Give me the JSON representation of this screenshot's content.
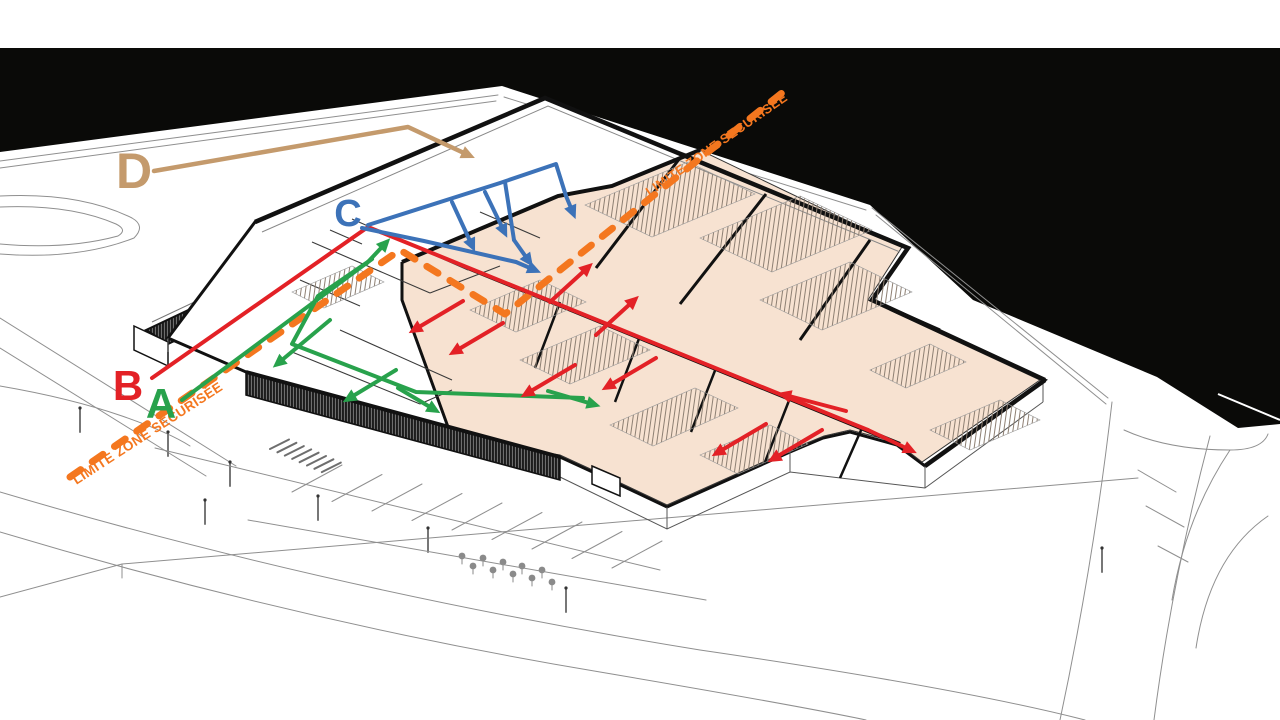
{
  "diagram": {
    "kind": "axonometric-building-security-circulation-diagram",
    "language": "fr"
  },
  "colors": {
    "page": "#ffffff",
    "water": "#0a0a08",
    "room_fill": "#f7e2d1",
    "building_line": "#141414",
    "site_line": "#8f8f8f",
    "boundary_orange": "#f4771f",
    "route_a_green": "#28a24c",
    "route_b_red": "#e32126",
    "route_c_blue": "#3c72b8",
    "route_d_tan": "#c49a6c"
  },
  "boundary": {
    "label": "LIMITE ZONE SECURISÉE",
    "color_key": "boundary_orange",
    "dash_polyline": [
      [
        70,
        477
      ],
      [
        400,
        250
      ],
      [
        505,
        314
      ],
      [
        792,
        85
      ]
    ],
    "texts": [
      {
        "x": 150,
        "y": 437,
        "rotation": -33,
        "size": 13.5
      },
      {
        "x": 719,
        "y": 148,
        "rotation": -35,
        "size": 13
      }
    ]
  },
  "routes": [
    {
      "id": "a",
      "label": "A",
      "color_key": "route_a_green",
      "width": 4,
      "label_x": 161,
      "label_y": 418,
      "label_size": 42,
      "paths": [
        [
          [
            182,
            400
          ],
          [
            372,
            259
          ]
        ],
        [
          [
            372,
            259
          ],
          [
            318,
            296
          ],
          [
            292,
            344
          ],
          [
            416,
            392
          ],
          [
            583,
            398
          ]
        ]
      ],
      "arrows": [
        [
          [
            366,
            264
          ],
          [
            382,
            247
          ]
        ],
        [
          [
            330,
            320
          ],
          [
            282,
            360
          ]
        ],
        [
          [
            396,
            370
          ],
          [
            353,
            396
          ]
        ],
        [
          [
            398,
            388
          ],
          [
            430,
            407
          ]
        ],
        [
          [
            548,
            391
          ],
          [
            589,
            403
          ]
        ]
      ]
    },
    {
      "id": "b",
      "label": "B",
      "color_key": "route_b_red",
      "width": 4,
      "label_x": 128,
      "label_y": 400,
      "label_size": 42,
      "paths": [
        [
          [
            152,
            378
          ],
          [
            368,
            227
          ],
          [
            868,
            430
          ]
        ]
      ],
      "arrows": [
        [
          [
            463,
            301
          ],
          [
            419,
            327
          ]
        ],
        [
          [
            503,
            323
          ],
          [
            459,
            349
          ]
        ],
        [
          [
            575,
            365
          ],
          [
            531,
            391
          ]
        ],
        [
          [
            656,
            358
          ],
          [
            612,
            384
          ]
        ],
        [
          [
            766,
            424
          ],
          [
            722,
            450
          ]
        ],
        [
          [
            822,
            430
          ],
          [
            778,
            456
          ]
        ],
        [
          [
            550,
            302
          ],
          [
            584,
            271
          ]
        ],
        [
          [
            596,
            335
          ],
          [
            630,
            304
          ]
        ],
        [
          [
            846,
            411
          ],
          [
            789,
            396
          ]
        ],
        [
          [
            868,
            430
          ],
          [
            906,
            448
          ]
        ]
      ]
    },
    {
      "id": "c",
      "label": "C",
      "color_key": "route_c_blue",
      "width": 4,
      "label_x": 348,
      "label_y": 226,
      "label_size": 38,
      "paths": [
        [
          [
            362,
            228
          ],
          [
            424,
            241
          ],
          [
            516,
            262
          ]
        ],
        [
          [
            368,
            225
          ],
          [
            500,
            183
          ],
          [
            556,
            164
          ],
          [
            566,
            196
          ]
        ],
        [
          [
            505,
            182
          ],
          [
            514,
            240
          ]
        ]
      ],
      "arrows": [
        [
          [
            452,
            202
          ],
          [
            470,
            241
          ]
        ],
        [
          [
            485,
            192
          ],
          [
            502,
            227
          ]
        ],
        [
          [
            514,
            240
          ],
          [
            526,
            257
          ]
        ],
        [
          [
            566,
            196
          ],
          [
            571,
            208
          ]
        ],
        [
          [
            516,
            262
          ],
          [
            530,
            268
          ]
        ]
      ]
    },
    {
      "id": "d",
      "label": "D",
      "color_key": "route_d_tan",
      "width": 4.5,
      "label_x": 134,
      "label_y": 188,
      "label_size": 50,
      "paths": [
        [
          [
            154,
            171
          ],
          [
            408,
            127
          ],
          [
            438,
            141
          ]
        ]
      ],
      "arrows": [
        [
          [
            438,
            141
          ],
          [
            464,
            153
          ]
        ]
      ]
    }
  ]
}
